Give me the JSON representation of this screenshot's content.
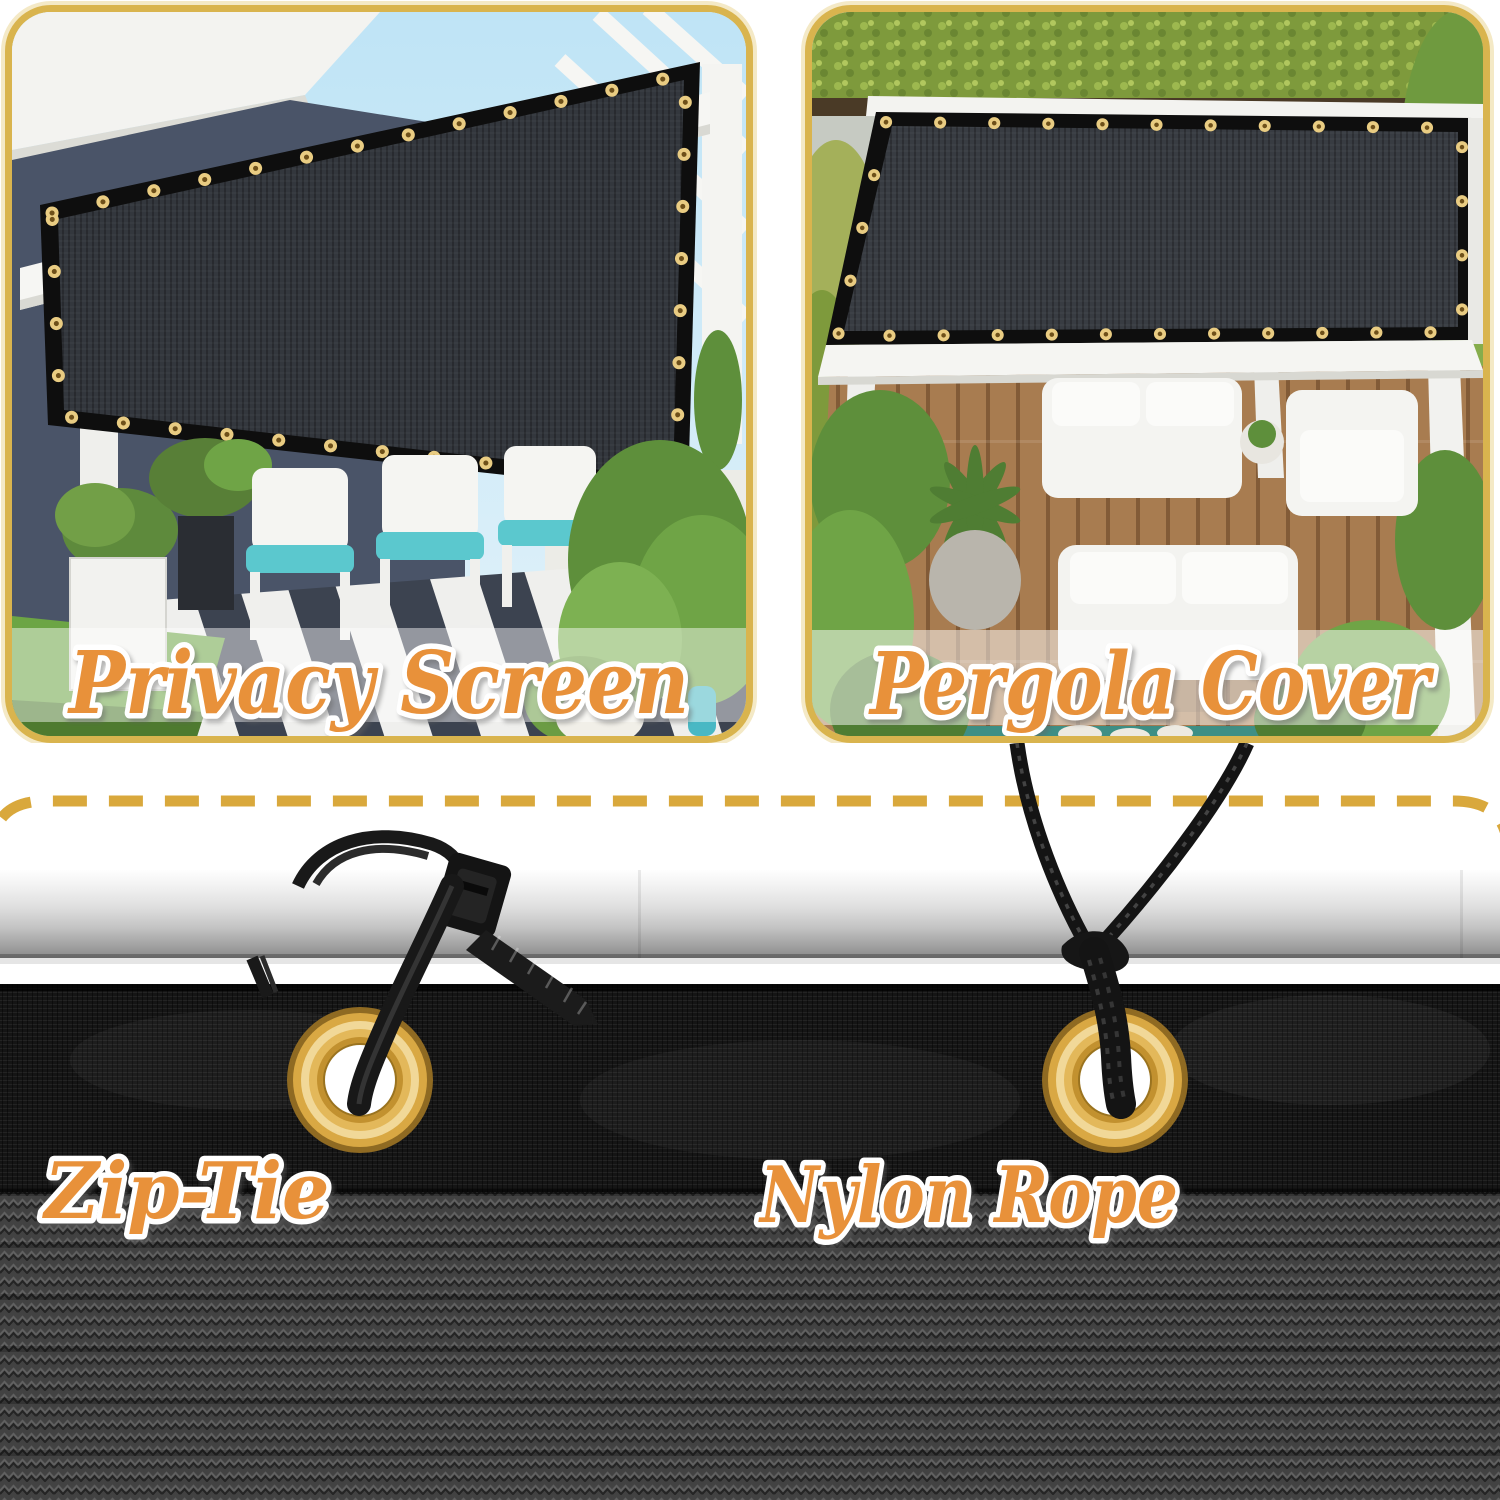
{
  "product_image": {
    "panels": [
      {
        "id": "privacy-screen",
        "caption": "Privacy Screen"
      },
      {
        "id": "pergola-cover",
        "caption": "Pergola Cover"
      }
    ],
    "bottom": {
      "labels": {
        "zip_tie": "Zip-Tie",
        "nylon_rope": "Nylon Rope"
      }
    },
    "colors": {
      "panel_border_gold": "#D9B44E",
      "panel_border_outer_cream": "#F4E9C6",
      "dashed_line_gold": "#D9A83C",
      "caption_orange": "#E8913A",
      "caption_outline": "#FFFFFF",
      "grommet_brass": "#D9A843",
      "shade_mesh_black": "#161616",
      "coarse_weave_gray": "#424242",
      "cushion_teal": "#5BC8CE",
      "pole_silver": "#D5D5D5"
    }
  }
}
